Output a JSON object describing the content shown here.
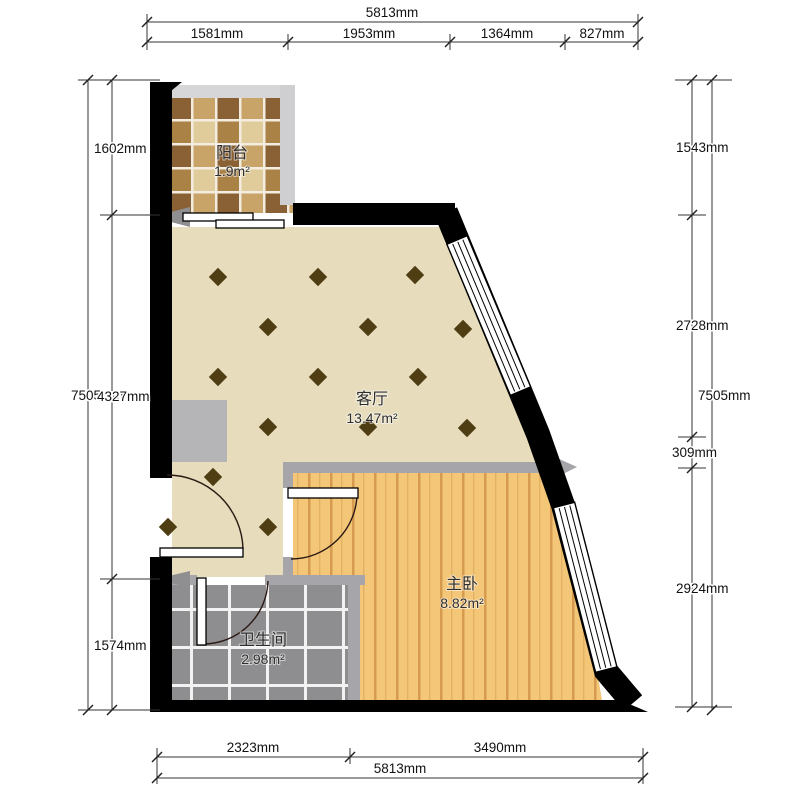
{
  "rooms": {
    "balcony": {
      "name": "阳台",
      "area": "1.9m²"
    },
    "living": {
      "name": "客厅",
      "area": "13.47m²"
    },
    "bedroom": {
      "name": "主卧",
      "area": "8.82m²"
    },
    "bathroom": {
      "name": "卫生间",
      "area": "2.98m²"
    }
  },
  "dimensions": {
    "top": {
      "total": "5813mm",
      "seg1": "1581mm",
      "seg2": "1953mm",
      "seg3": "1364mm",
      "seg4": "827mm"
    },
    "bottom": {
      "total": "5813mm",
      "seg1": "2323mm",
      "seg2": "3490mm"
    },
    "left": {
      "total": "7505mm",
      "seg1": "1602mm",
      "seg2": "4327mm",
      "seg3": "1574mm"
    },
    "right": {
      "total": "7505mm",
      "seg1": "1543mm",
      "seg2": "2728mm",
      "seg3": "309mm",
      "seg4": "2924mm"
    }
  },
  "colors": {
    "exterior_wall": "#000000",
    "interior_wall": "#a6a6aa",
    "living_floor": "#e7ddbd",
    "wood_floor": "#f3c678",
    "bath_tile": "#8e8e90",
    "diamond_accent": "#4f3d14",
    "dimension_line": "#333333"
  }
}
